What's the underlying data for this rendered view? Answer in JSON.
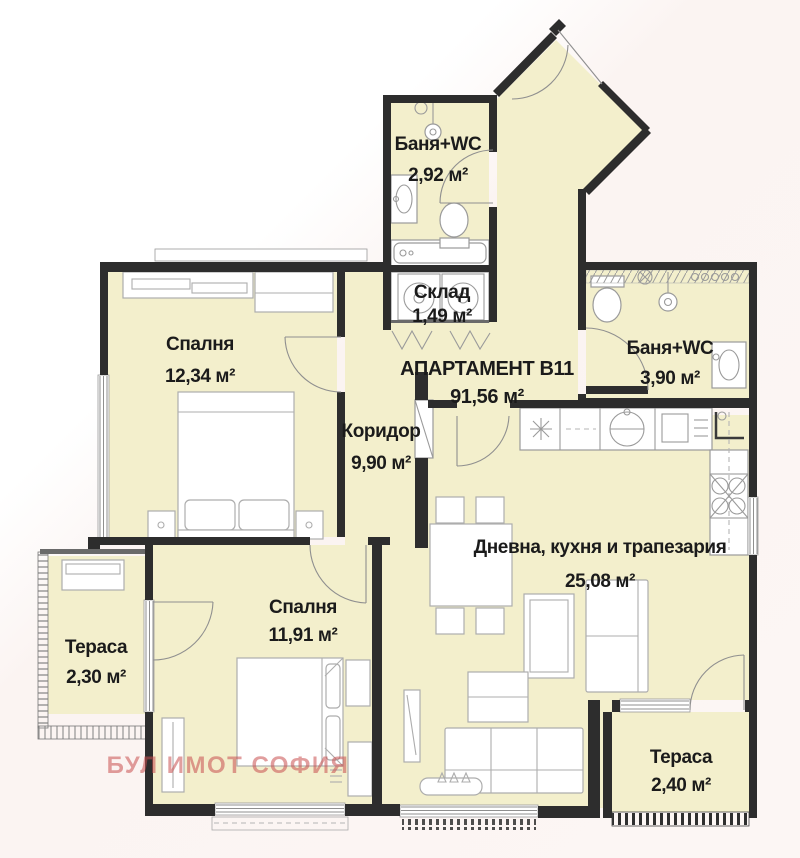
{
  "plan": {
    "apartment": {
      "name": "АПАРТАМЕНТ В11",
      "area": "91,56 м²"
    },
    "rooms": {
      "bath_top": {
        "name": "Баня+WC",
        "area": "2,92 м²"
      },
      "storage": {
        "name": "Склад",
        "area": "1,49 м²"
      },
      "bath_right": {
        "name": "Баня+WC",
        "area": "3,90 м²"
      },
      "bedroom1": {
        "name": "Спалня",
        "area": "12,34 м²"
      },
      "corridor": {
        "name": "Коридор",
        "area": "9,90 м²"
      },
      "living": {
        "name": "Дневна, кухня и трапезария",
        "area": "25,08 м²"
      },
      "bedroom2": {
        "name": "Спалня",
        "area": "11,91 м²"
      },
      "terrace_left": {
        "name": "Тераса",
        "area": "2,30 м²"
      },
      "terrace_right": {
        "name": "Тераса",
        "area": "2,40 м²"
      }
    },
    "watermark": "БУЛ ИМОТ СОФИЯ",
    "colors": {
      "room_fill": "#f3efcc",
      "wall": "#2d2d2d",
      "watermark": "#c94f4f"
    }
  }
}
